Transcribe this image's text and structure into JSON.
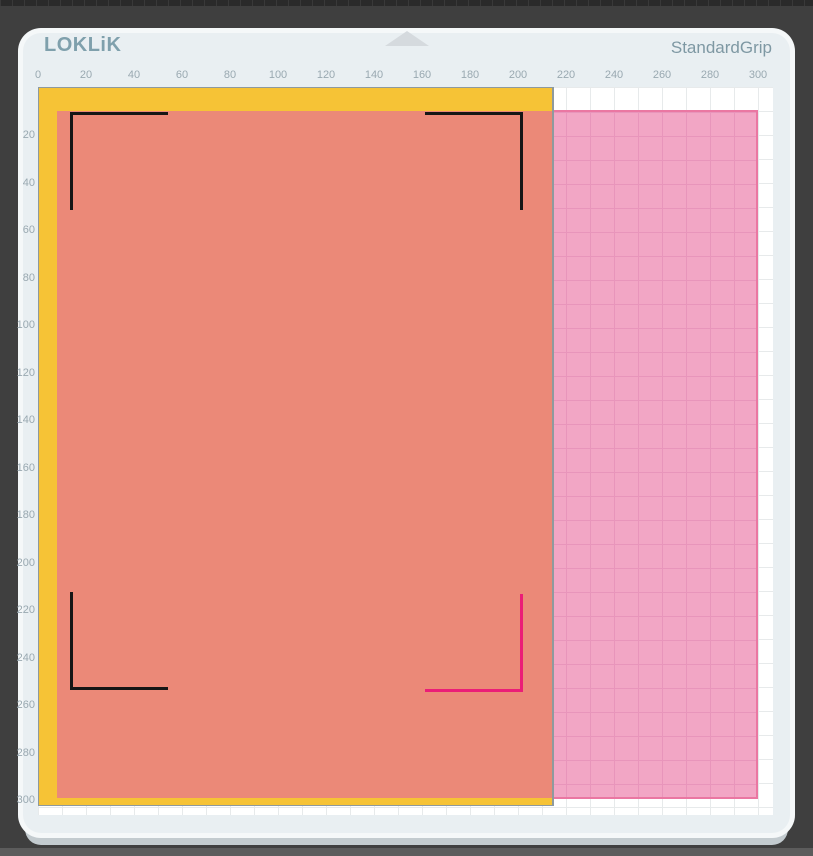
{
  "header": {
    "logo_text": "LOKLiK",
    "mat_name": "StandardGrip"
  },
  "rulers": {
    "unit_step": 20,
    "top_labels": [
      "0",
      "20",
      "40",
      "60",
      "80",
      "100",
      "120",
      "140",
      "160",
      "180",
      "200",
      "220",
      "240",
      "260",
      "280",
      "300"
    ],
    "left_labels": [
      "20",
      "40",
      "60",
      "80",
      "100",
      "120",
      "140",
      "160",
      "180",
      "200",
      "220",
      "240",
      "260",
      "280",
      "300"
    ]
  },
  "mat": {
    "type": "StandardGrip",
    "grid_range": "0-300"
  },
  "registration_marks": {
    "count": 4,
    "positions": [
      "top-left",
      "top-right",
      "bottom-left",
      "bottom-right"
    ],
    "highlighted_position": "bottom-right"
  },
  "colors": {
    "page_bg": "#3F3F3F",
    "chrome_top": "#2A2A2A",
    "chrome_bottom": "#5C5C5C",
    "mat_bg": "#E9EFF2",
    "mat_edge": "#F5F8F9",
    "mat_shadow": "#C3CBCF",
    "grid_line": "#E7EAEB",
    "adhesive": "#F2A6C5",
    "adhesive_grid": "#E895BB",
    "adhesive_edge": "#EA77A2",
    "base_sheet": "#F6C336",
    "base_sheet_edge": "#8E9A9E",
    "print_sheet": "#EB8978",
    "mark": "#161616",
    "mark_accent": "#EB1D77",
    "ruler_text": "#9AA9B1",
    "brand": "#7FA0AC",
    "grip_text": "#7E98A3",
    "notch": "#D5DADE"
  }
}
